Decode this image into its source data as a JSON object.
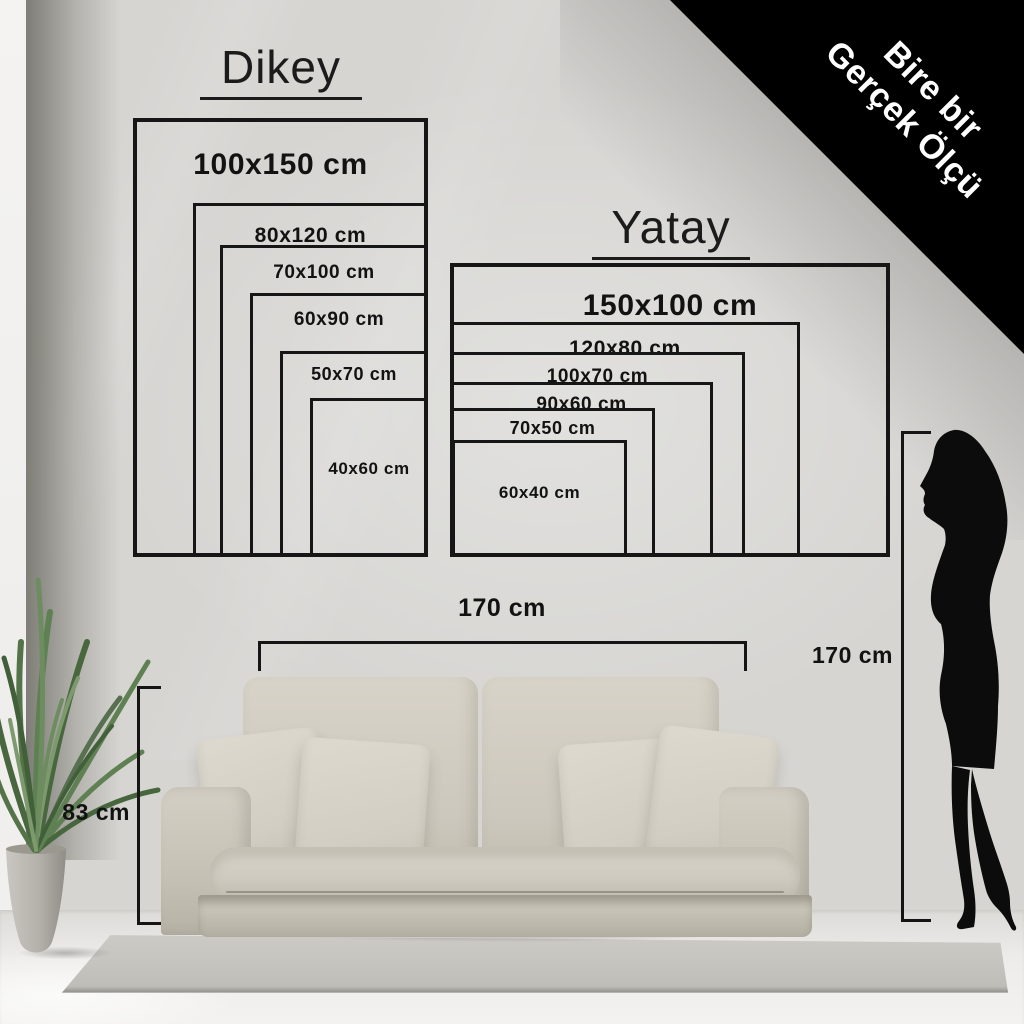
{
  "corner_ribbon": {
    "line1": "Bire bir",
    "line2": "Gerçek Ölçü",
    "bg_color": "#000000",
    "text_color": "#ffffff"
  },
  "size_guide": {
    "vertical": {
      "title": "Dikey",
      "sizes": [
        "100x150 cm",
        "80x120 cm",
        "70x100 cm",
        "60x90 cm",
        "50x70 cm",
        "40x60 cm"
      ]
    },
    "horizontal": {
      "title": "Yatay",
      "sizes": [
        "150x100 cm",
        "120x80 cm",
        "100x70 cm",
        "90x60 cm",
        "70x50 cm",
        "60x40 cm"
      ]
    },
    "outline_color": "#161616"
  },
  "room_reference": {
    "sofa_width_label": "170 cm",
    "sofa_height_label": "83 cm",
    "person_height_label": "170 cm"
  }
}
